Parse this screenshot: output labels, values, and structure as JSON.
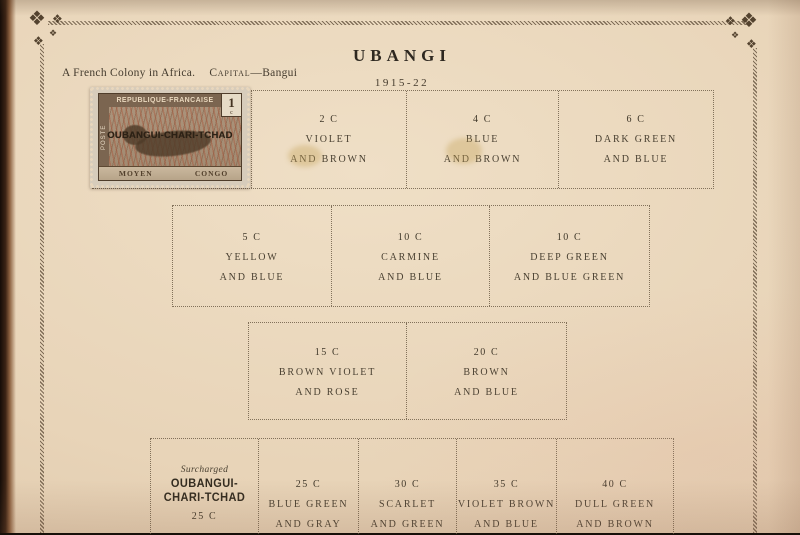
{
  "colors": {
    "page_background": "#e9d7bd",
    "ink": "#4a4132",
    "border_ink": "#6d5b46",
    "stamp_frame_brown": "#7b6550",
    "stamp_grass_red": "#a8563a"
  },
  "header": {
    "colony_line": "A French Colony in Africa.",
    "capital_label": "Capital",
    "capital_value": "—Bangui",
    "title": "UBANGI",
    "years": "1915-22"
  },
  "stamp": {
    "country": "REPUBLIQUE-FRANCAISE",
    "value": "1",
    "value_unit": "c",
    "side_label": "POSTE",
    "overprint": "OUBANGUI-CHARI-TCHAD",
    "ribbon_left": "MOYEN",
    "ribbon_right": "CONGO"
  },
  "rows": [
    {
      "cells": [
        {
          "value": "",
          "line1": "",
          "line2": ""
        },
        {
          "value": "2 C",
          "line1": "VIOLET",
          "line2": "AND BROWN"
        },
        {
          "value": "4 C",
          "line1": "BLUE",
          "line2": "AND BROWN"
        },
        {
          "value": "6 C",
          "line1": "DARK GREEN",
          "line2": "AND BLUE"
        }
      ]
    },
    {
      "cells": [
        {
          "value": "5 C",
          "line1": "YELLOW",
          "line2": "AND BLUE"
        },
        {
          "value": "10 C",
          "line1": "CARMINE",
          "line2": "AND BLUE"
        },
        {
          "value": "10 C",
          "line1": "DEEP GREEN",
          "line2": "AND BLUE GREEN"
        }
      ]
    },
    {
      "cells": [
        {
          "value": "15 C",
          "line1": "BROWN VIOLET",
          "line2": "AND ROSE"
        },
        {
          "value": "20 C",
          "line1": "BROWN",
          "line2": "AND BLUE"
        }
      ]
    },
    {
      "cells": [
        {
          "surcharged_label": "Surcharged",
          "overprint_line1": "OUBANGUI-",
          "overprint_line2": "CHARI-TCHAD",
          "value": "25 C"
        },
        {
          "value": "25 C",
          "line1": "BLUE GREEN",
          "line2": "AND GRAY"
        },
        {
          "value": "30 C",
          "line1": "SCARLET",
          "line2": "AND GREEN"
        },
        {
          "value": "35 C",
          "line1": "VIOLET BROWN",
          "line2": "AND BLUE"
        },
        {
          "value": "40 C",
          "line1": "DULL GREEN",
          "line2": "AND BROWN"
        }
      ]
    }
  ]
}
